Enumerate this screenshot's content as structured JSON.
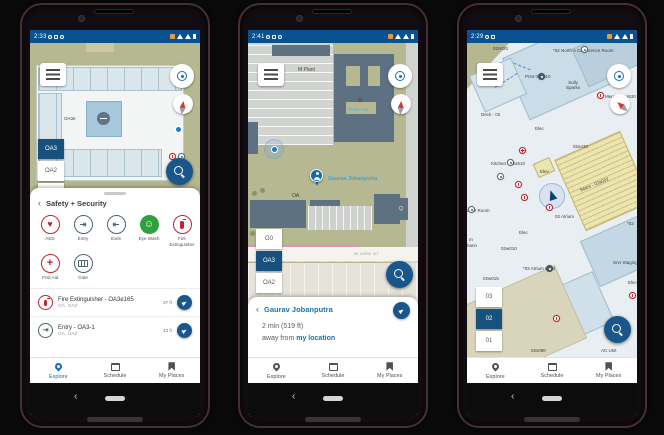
{
  "icons": {
    "back": "‹",
    "heart": "♥",
    "entry": "⇥",
    "exits": "⇤",
    "face": "☺",
    "plus": "+"
  },
  "colors": {
    "status_bar": "#0a5191",
    "accent_blue": "#19568c",
    "selected_floor": "#17527f",
    "nav_active": "#1669c1",
    "person_label_blue": "#35a7d9",
    "link_blue": "#1a74ad",
    "alert_red": "#c4202f",
    "safety_teal": "#47666a",
    "eyewash_green": "#2fa03a"
  },
  "nav": {
    "explore": "Explore",
    "schedule": "Schedule",
    "my_places": "My Places"
  },
  "phone1": {
    "time": "2:33",
    "map": {
      "room": "OA3e"
    },
    "floors": [
      "OA3",
      "OA2",
      "OA1"
    ],
    "sheet": {
      "title": "Safety + Security",
      "categories": [
        {
          "label": "AED"
        },
        {
          "label": "Entry"
        },
        {
          "label": "Exits"
        },
        {
          "label": "Eye Wash"
        },
        {
          "label": "Fire Extinguisher"
        },
        {
          "label": "First Aid"
        },
        {
          "label": "Gate"
        }
      ],
      "results": [
        {
          "title": "Fire Extinguisher - OA3e165",
          "location": "OA, OA3",
          "distance": "37 ft"
        },
        {
          "title": "Entry - OA3-1",
          "location": "OA, OA3",
          "distance": "43 ft"
        }
      ]
    }
  },
  "phone2": {
    "time": "2:41",
    "map": {
      "labels": [
        "M Plant",
        "O Plant",
        "M",
        "OA",
        "Q"
      ],
      "park": "Tuttle Par",
      "street": "W 43RD ST",
      "person": "Gaurav Jobanputra"
    },
    "floors": [
      "G0",
      "OA3",
      "OA2"
    ],
    "sheet": {
      "title": "Gaurav Jobanputra",
      "eta": "2 min (519 ft)",
      "away_prefix": "away from",
      "away_link": "my location"
    }
  },
  "phone3": {
    "time": "2:29",
    "floors": [
      "03",
      "02",
      "01"
    ],
    "map_labels": [
      "02n020",
      "*02 North A Conference Room",
      "Print 02n010",
      "Sully Sparks",
      "Men's - 02a530",
      "Deck - 02",
      "Elec",
      "02a430",
      "Kitchen - 02a510",
      "Elev",
      "Stairs - 02a002",
      "02 Atrium",
      "Conference Room",
      "Elec",
      "02w010",
      "*02 Atrium West",
      "02w015",
      "Srvr Staging",
      "Elec",
      "*02",
      "02s080",
      "AC Unit",
      "hann",
      "m"
    ]
  }
}
